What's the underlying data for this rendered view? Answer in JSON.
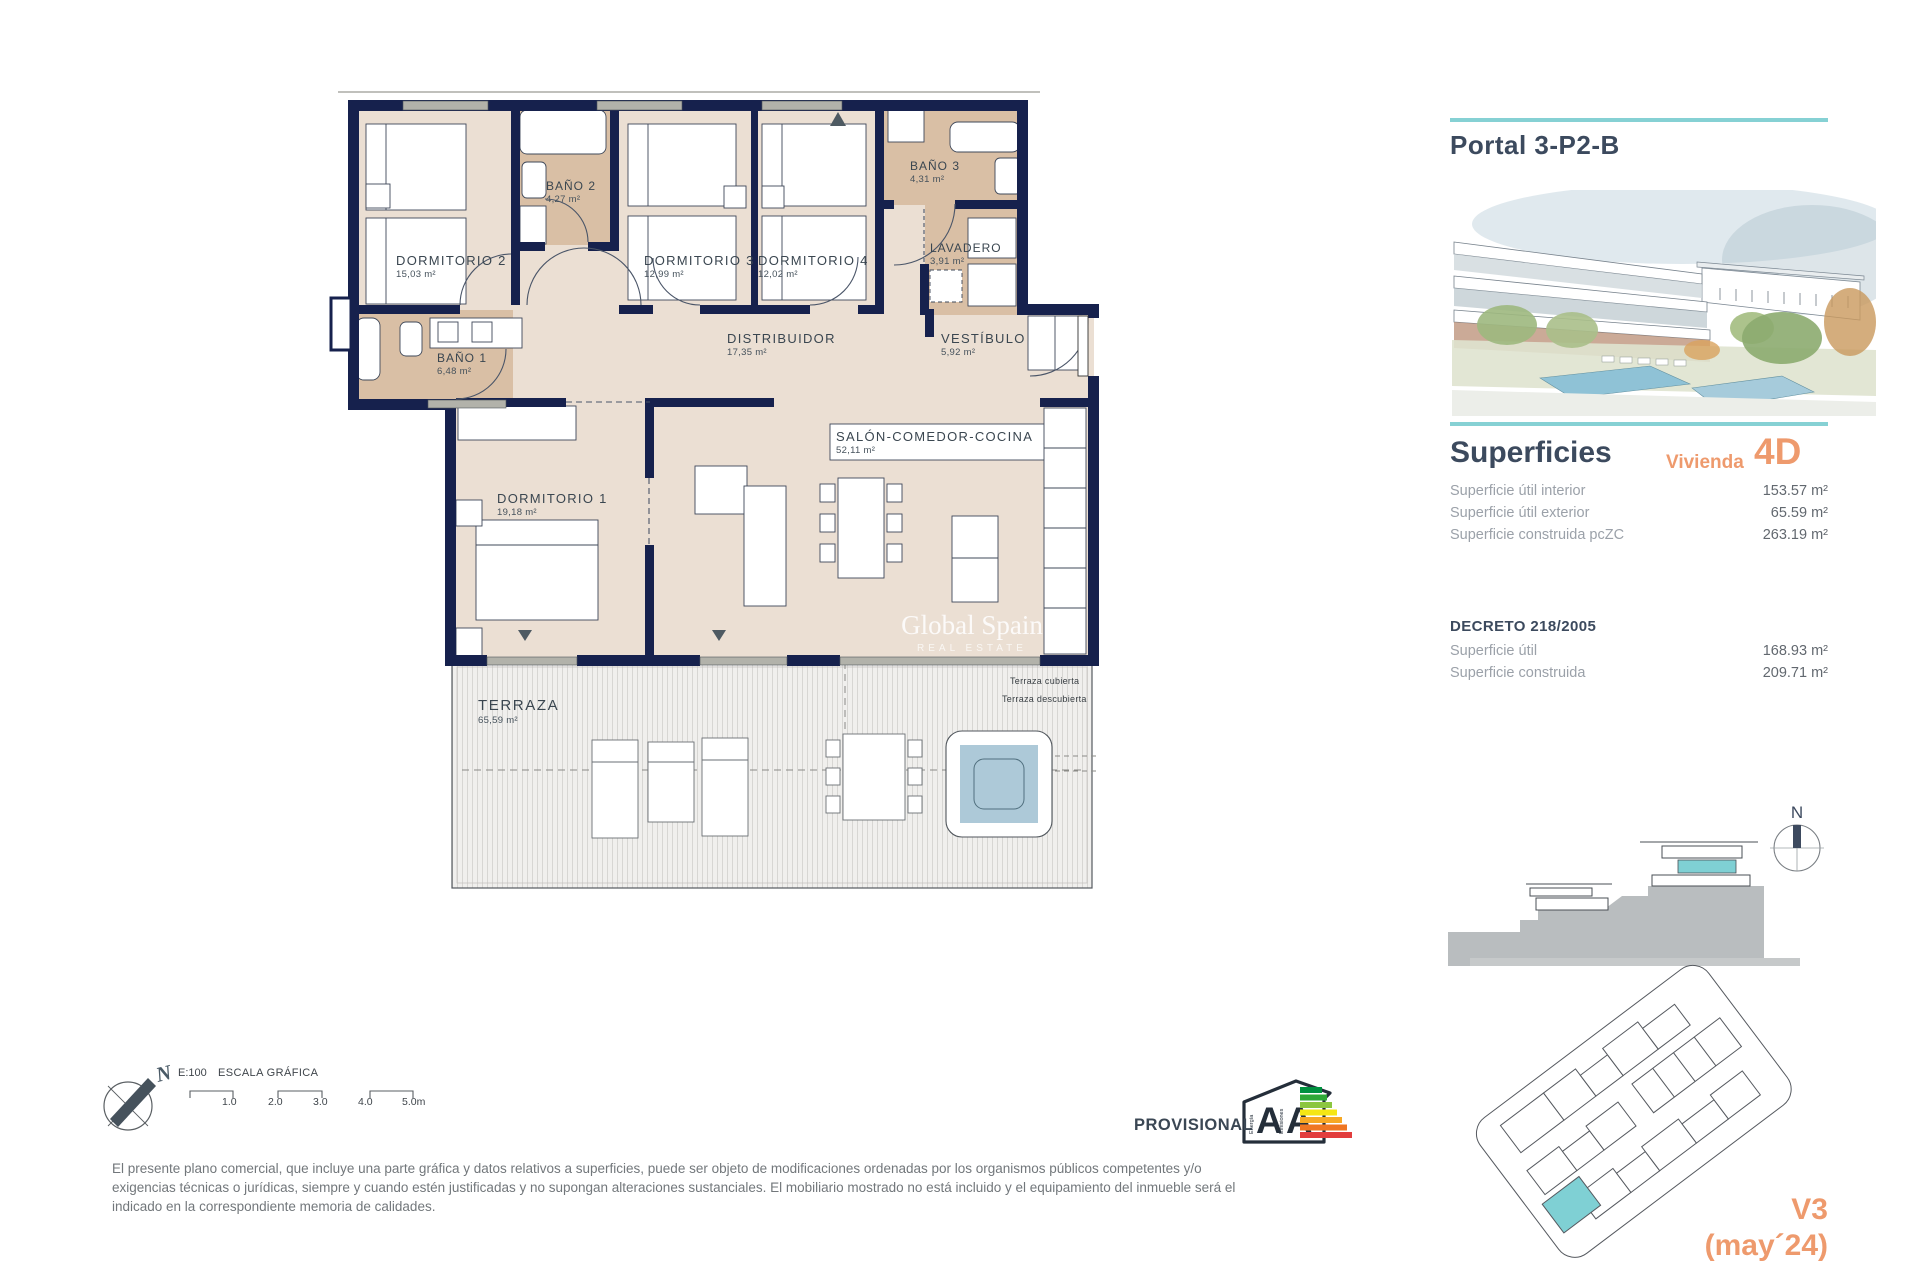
{
  "theme": {
    "teal": "#86d1d4",
    "orange": "#ee9a6d",
    "wall_navy": "#16214d",
    "slate_text": "#3c4a5e",
    "wet_room_beige": "#d9bfa5",
    "floor_beige": "#ebdfd3"
  },
  "plan": {
    "rooms": [
      {
        "name": "DORMITORIO 2",
        "area": "15,03 m²"
      },
      {
        "name": "BAÑO 2",
        "area": "4,27 m²"
      },
      {
        "name": "DORMITORIO 3",
        "area": "12,99 m²"
      },
      {
        "name": "DORMITORIO 4",
        "area": "12,02 m²"
      },
      {
        "name": "BAÑO 3",
        "area": "4,31 m²"
      },
      {
        "name": "LAVADERO",
        "area": "3,91 m²"
      },
      {
        "name": "BAÑO 1",
        "area": "6,48 m²"
      },
      {
        "name": "DISTRIBUIDOR",
        "area": "17,35 m²"
      },
      {
        "name": "VESTÍBULO",
        "area": "5,92 m²"
      },
      {
        "name": "SALÓN-COMEDOR-COCINA",
        "area": "52,11 m²"
      },
      {
        "name": "DORMITORIO 1",
        "area": "19,18 m²"
      },
      {
        "name": "TERRAZA",
        "area": "65,59 m²"
      }
    ],
    "terrace_notes": {
      "covered": "Terraza cubierta",
      "uncovered": "Terraza descubierta"
    },
    "watermark": {
      "brand": "Global Spain",
      "tagline": "REAL ESTATE"
    }
  },
  "panel": {
    "title": "Portal 3-P2-B",
    "superficies": {
      "heading": "Superficies",
      "vivienda_label": "Vivienda",
      "vivienda_code": "4D",
      "rows": [
        {
          "label": "Superficie útil interior",
          "value": "153.57 m²"
        },
        {
          "label": "Superficie útil exterior",
          "value": "65.59 m²"
        },
        {
          "label": "Superficie construida pcZC",
          "value": "263.19 m²"
        }
      ]
    },
    "decreto": {
      "heading": "DECRETO 218/2005",
      "rows": [
        {
          "label": "Superficie útil",
          "value": "168.93 m²"
        },
        {
          "label": "Superficie construida",
          "value": "209.71 m²"
        }
      ]
    },
    "section_compass_label": "N",
    "version_line1": "V3",
    "version_line2": "(may´24)"
  },
  "footer": {
    "compass_label": "N",
    "scale": {
      "ratio": "E:100",
      "title": "ESCALA GRÁFICA",
      "ticks": [
        "1.0",
        "2.0",
        "3.0",
        "4.0",
        "5.0m"
      ]
    },
    "disclaimer_lines": [
      "El presente plano comercial, que incluye una parte gráfica y datos relativos a superficies, puede ser objeto de modificaciones ordenadas por los organismos públicos competentes y/o",
      "exigencias técnicas o jurídicas, siempre y cuando estén justificadas y no supongan alteraciones sustanciales. El mobiliario mostrado no está incluido y el equipamiento del inmueble será el",
      "indicado en la correspondiente memoria de calidades."
    ],
    "provisional": "PROVISIONAL",
    "energy": {
      "letter_energy": "A",
      "letter_emissions": "A",
      "word_energy": "Energía",
      "word_emissions": "Emisiones"
    }
  }
}
